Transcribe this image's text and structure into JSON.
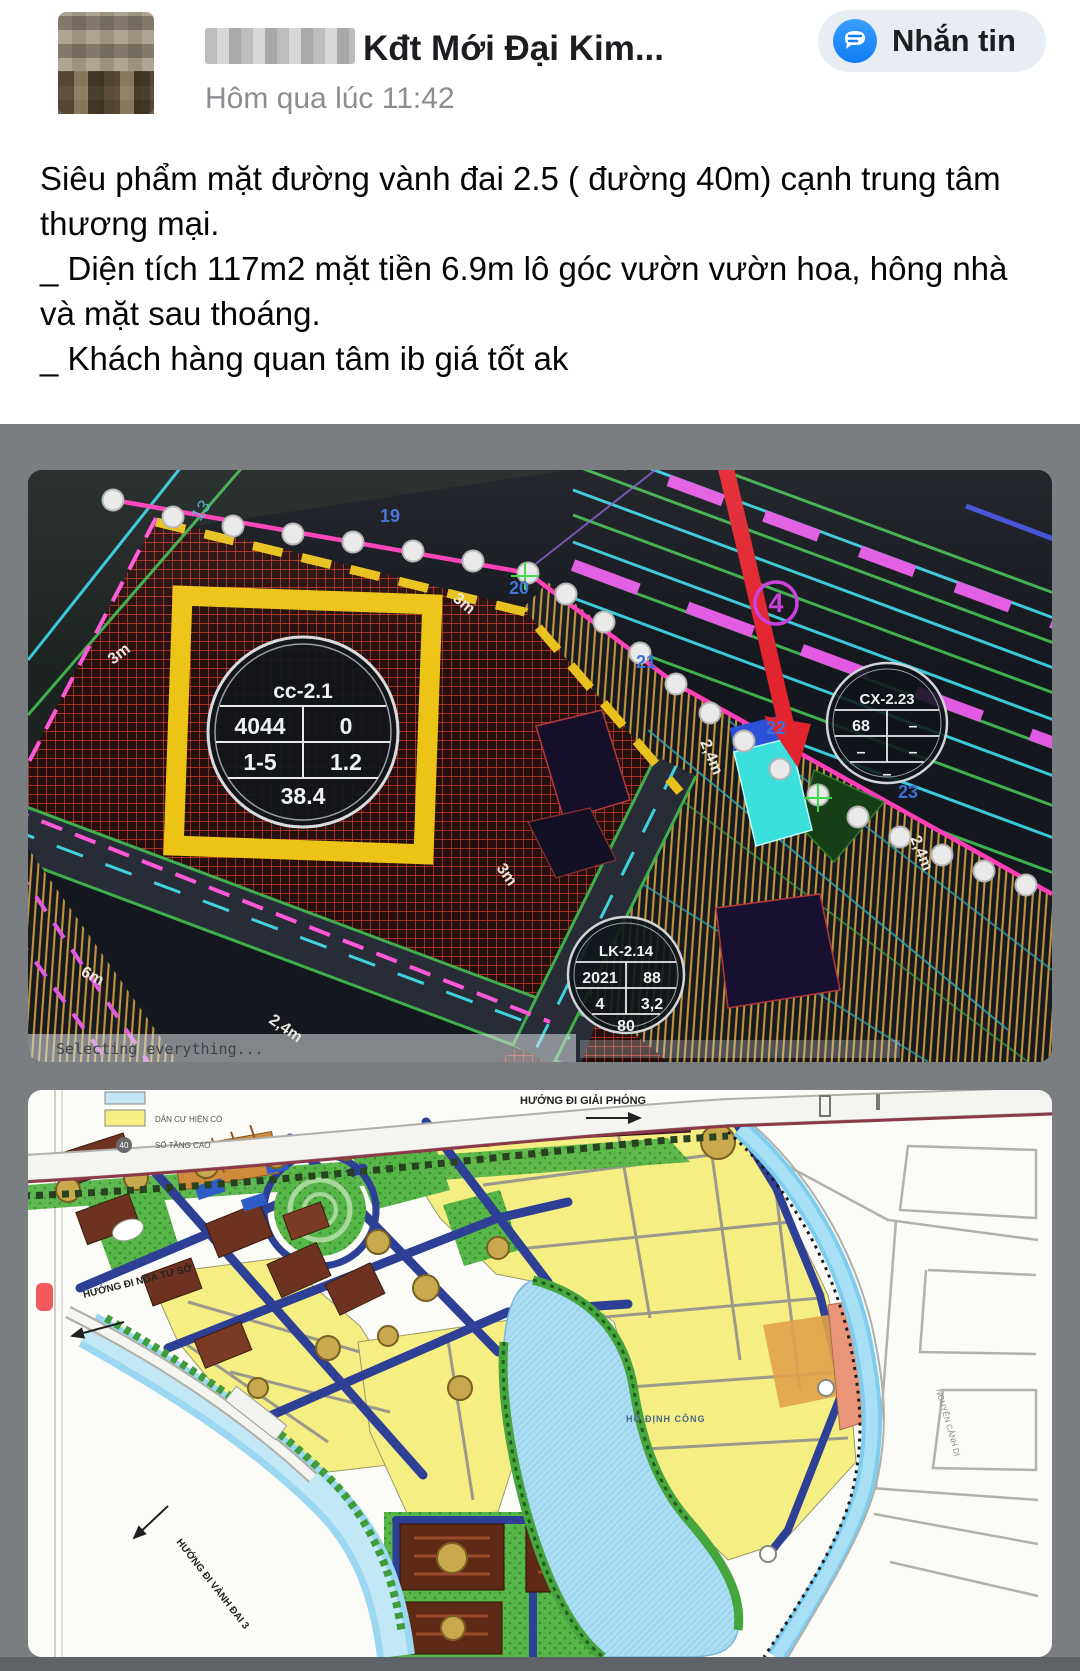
{
  "header": {
    "author_name_visible": "Kđt Mới Đại Kim...",
    "timestamp": "Hôm qua lúc 11:42",
    "message_button_label": "Nhắn tin"
  },
  "post": {
    "paragraph1": "Siêu phẩm mặt đường vành đai 2.5 ( đường 40m) cạnh trung tâm thương mại.",
    "paragraph2": "_ Diện tích 117m2 mặt tiền 6.9m lô góc vườn vườn hoa,  hông nhà và mặt sau thoáng.",
    "paragraph3": "_ Khách hàng quan tâm ib giá tốt ak"
  },
  "cad": {
    "status_text": "Selecting everything...",
    "badge_road": "4",
    "misc_label": "13",
    "plot_numbers": {
      "n19": "19",
      "n20": "20",
      "n21": "21",
      "n22": "22",
      "n23": "23"
    },
    "dims": {
      "m3_a": "3m",
      "m3_b": "3m",
      "m3_c": "3m",
      "m6": "6m",
      "m24_a": "2,4m",
      "m24_b": "2,4m",
      "m24_c": "2,4m"
    },
    "circle_cc": {
      "title": "cc-2.1",
      "r1c1": "4044",
      "r1c2": "0",
      "r2c1": "1-5",
      "r2c2": "1.2",
      "footer": "38.4"
    },
    "circle_cx": {
      "title": "CX-2.23",
      "r1c1": "68",
      "r1c2": "–",
      "r2c1": "–",
      "r2c2": "–",
      "footer": "–"
    },
    "circle_lk": {
      "title": "LK-2.14",
      "r1c1": "2021",
      "r1c2": "88",
      "r2c1": "4",
      "r2c2": "3,2",
      "footer": "80"
    }
  },
  "map": {
    "legend": {
      "residential": "DÂN CƯ HIỆN CÓ",
      "floors_badge": "40",
      "floors": "SỐ TẦNG CAO"
    },
    "labels": {
      "giai_phong": "HƯỚNG ĐI GIẢI PHÓNG",
      "nga_tu_so": "HƯỚNG ĐI NGÃ TƯ SỞ",
      "vanh_dai_3": "HƯỚNG ĐI VÀNH ĐAI 3",
      "lake": "HỒ ĐỊNH CÔNG",
      "street_right": "NGUYỄN CẢNH DỊ"
    }
  },
  "colors": {
    "messenger_blue": "#1780f8",
    "arrow_red": "#e2242f",
    "plot_highlight": "#3be0dc",
    "hatch_red": "#cf3b2c",
    "parcel_yellow": "#edc416"
  }
}
